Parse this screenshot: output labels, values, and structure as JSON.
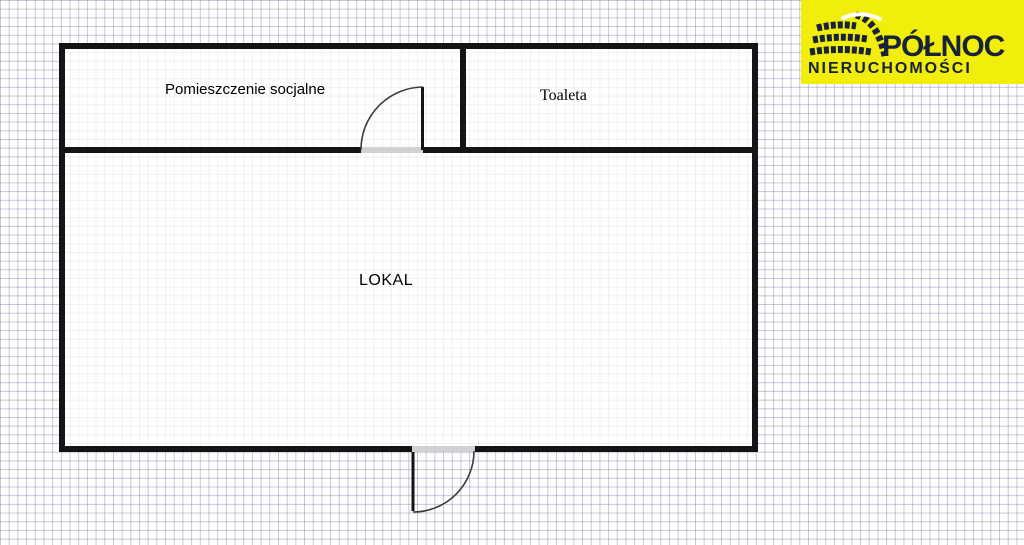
{
  "floorplan": {
    "rooms": [
      {
        "id": "pomieszczenie-socjalne",
        "label": "Pomieszczenie socjalne"
      },
      {
        "id": "toaleta",
        "label": "Toaleta"
      },
      {
        "id": "lokal",
        "label": "LOKAL"
      }
    ]
  },
  "logo": {
    "title": "PÓŁNOC",
    "subtitle": "NIERUCHOMOŚCI"
  },
  "colors": {
    "wall": "#141414",
    "door": "#d2d2d2",
    "grid_line": "rgba(140,140,175,0.5)",
    "logo_bg": "#f2ee0b",
    "logo_text": "#18223a"
  }
}
